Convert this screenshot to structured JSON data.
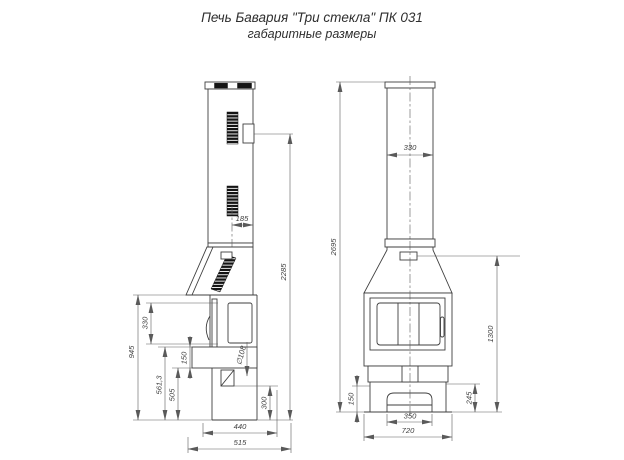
{
  "title": {
    "line1": "Печь Бавария \"Три стекла\" ПК 031",
    "line2": "габаритные размеры"
  },
  "colors": {
    "line": "#3f3f3f",
    "dimension_line": "#5a5a5a",
    "vent_fill": "#141414",
    "background": "#ffffff"
  },
  "side_view": {
    "dims": {
      "vent_offset": "185",
      "flue_outlet_height": "2285",
      "body_height": "945",
      "glass_height": "330",
      "shelf_top_height": "561,3",
      "shelf_bottom_height": "505",
      "shelf_thickness": "150",
      "pipe_diameter": "∅108",
      "rear_outlet_height": "300",
      "depth_body": "440",
      "depth_total": "515"
    }
  },
  "front_view": {
    "dims": {
      "chimney_width": "330",
      "total_height": "2695",
      "firebox_top_height": "1300",
      "plinth_height": "150",
      "niche_height": "245",
      "niche_width": "350",
      "width_total": "720"
    }
  }
}
